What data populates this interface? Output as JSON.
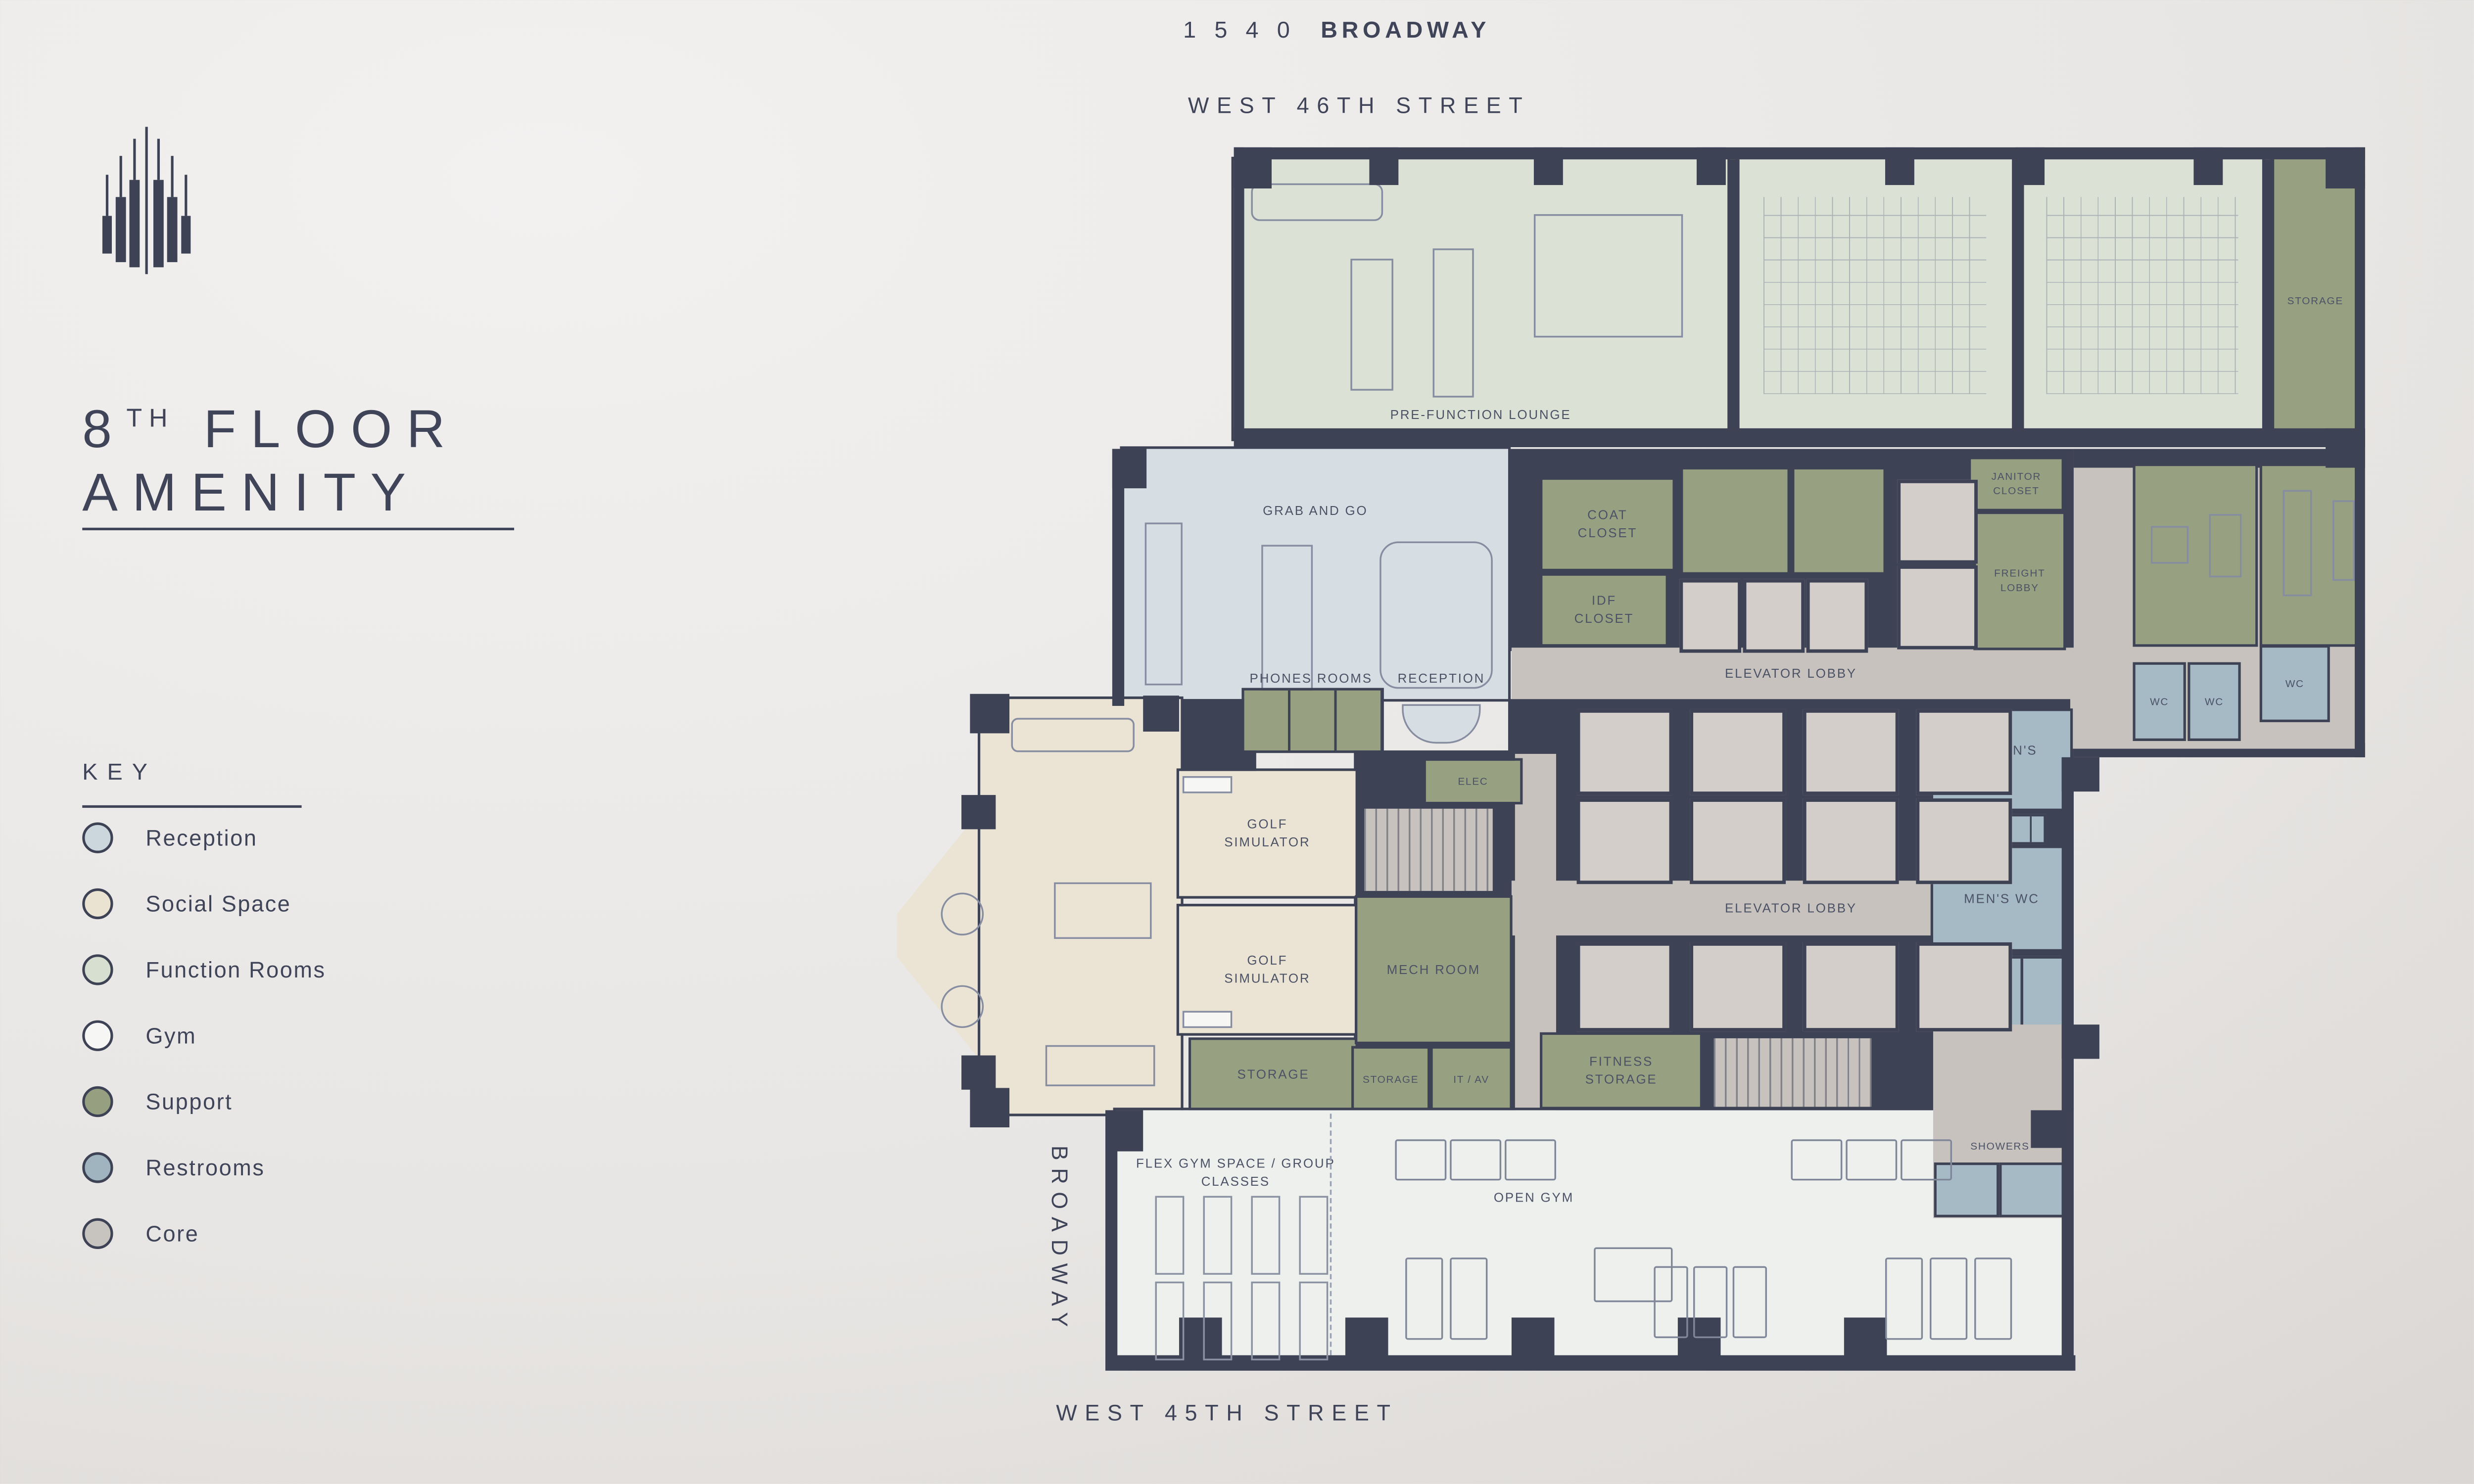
{
  "palette": {
    "wall": "#3d4254",
    "ink": "#3f4459",
    "label": "#4c5265",
    "reception": "#d7dee3",
    "social": "#ebe4d4",
    "function_rooms": "#dbe1d5",
    "gym": "#eef0ee",
    "support": "#97a181",
    "restrooms": "#a5bac4",
    "core": "#c8c2bf",
    "elevator_car": "#d4cecb",
    "background_light": "#f2f1f0",
    "background_dark": "#d6d2cf"
  },
  "brand": {
    "number": "1 5 4 0",
    "name": "BROADWAY"
  },
  "heading": {
    "floor": "8",
    "ordinal": "TH",
    "word1": "FLOOR",
    "word2": "AMENITY"
  },
  "key": {
    "title": "KEY",
    "items": [
      {
        "label": "Reception",
        "color": "#ccd6dd"
      },
      {
        "label": "Social Space",
        "color": "#ebe3d1"
      },
      {
        "label": "Function Rooms",
        "color": "#d7dfd1"
      },
      {
        "label": "Gym",
        "color": "#f6f6f4"
      },
      {
        "label": "Support",
        "color": "#969f80"
      },
      {
        "label": "Restrooms",
        "color": "#9fb4bf"
      },
      {
        "label": "Core",
        "color": "#c7c3be"
      }
    ]
  },
  "streets": {
    "north": "WEST 46TH STREET",
    "south": "WEST 45TH STREET",
    "west": "BROADWAY"
  },
  "compass": {
    "north_label": "N"
  },
  "rooms": {
    "pre_function_lounge": "PRE-FUNCTION LOUNGE",
    "storage_top": "STORAGE",
    "grab_and_go": "GRAB AND GO",
    "phones_rooms": "PHONES ROOMS",
    "reception": "RECEPTION",
    "coat_closet": "COAT CLOSET",
    "idf_closet": "IDF CLOSET",
    "janitor_closet": "JANITOR CLOSET",
    "freight_lobby": "FREIGHT LOBBY",
    "elevator_lobby_upper": "ELEVATOR LOBBY",
    "elevator_lobby_lower": "ELEVATOR LOBBY",
    "elec": "ELEC",
    "golf_simulator_1": "GOLF SIMULATOR",
    "golf_simulator_2": "GOLF SIMULATOR",
    "mech_room": "MECH ROOM",
    "storage_social": "STORAGE",
    "storage_small": "STORAGE",
    "it_av": "IT / AV",
    "fitness_storage": "FITNESS STORAGE",
    "womens_wc": "WOMEN'S WC",
    "mens_wc": "MEN'S WC",
    "wc_1": "WC",
    "wc_2": "WC",
    "wc_3": "WC",
    "showers": "SHOWERS",
    "flex_gym": "FLEX GYM SPACE / GROUP CLASSES",
    "open_gym": "OPEN GYM"
  }
}
